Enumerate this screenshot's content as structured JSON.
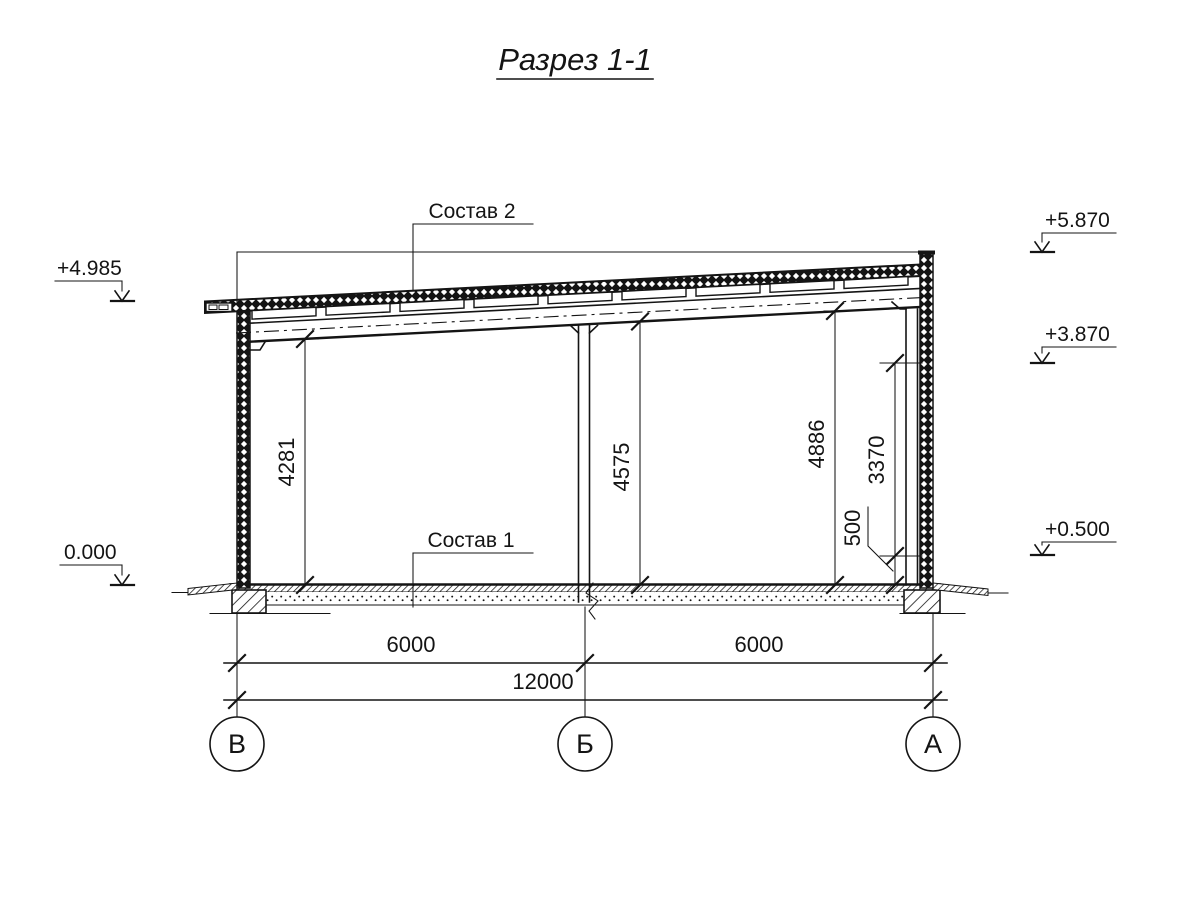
{
  "title": "Разрез 1-1",
  "callouts": {
    "roof_composition": "Состав 2",
    "floor_composition": "Состав 1"
  },
  "elevations": {
    "left_eave": "+4.985",
    "ground_zero": "0.000",
    "parapet_top": "+5.870",
    "right_mid": "+3.870",
    "right_plinth": "+0.500"
  },
  "dimensions": {
    "clear_height_left": "4281",
    "clear_height_middle": "4575",
    "clear_height_right": "4886",
    "wall_upper": "3370",
    "plinth": "500",
    "bay_left": "6000",
    "bay_right": "6000",
    "total_span": "12000"
  },
  "axes": {
    "left": "В",
    "middle": "Б",
    "right": "А"
  }
}
